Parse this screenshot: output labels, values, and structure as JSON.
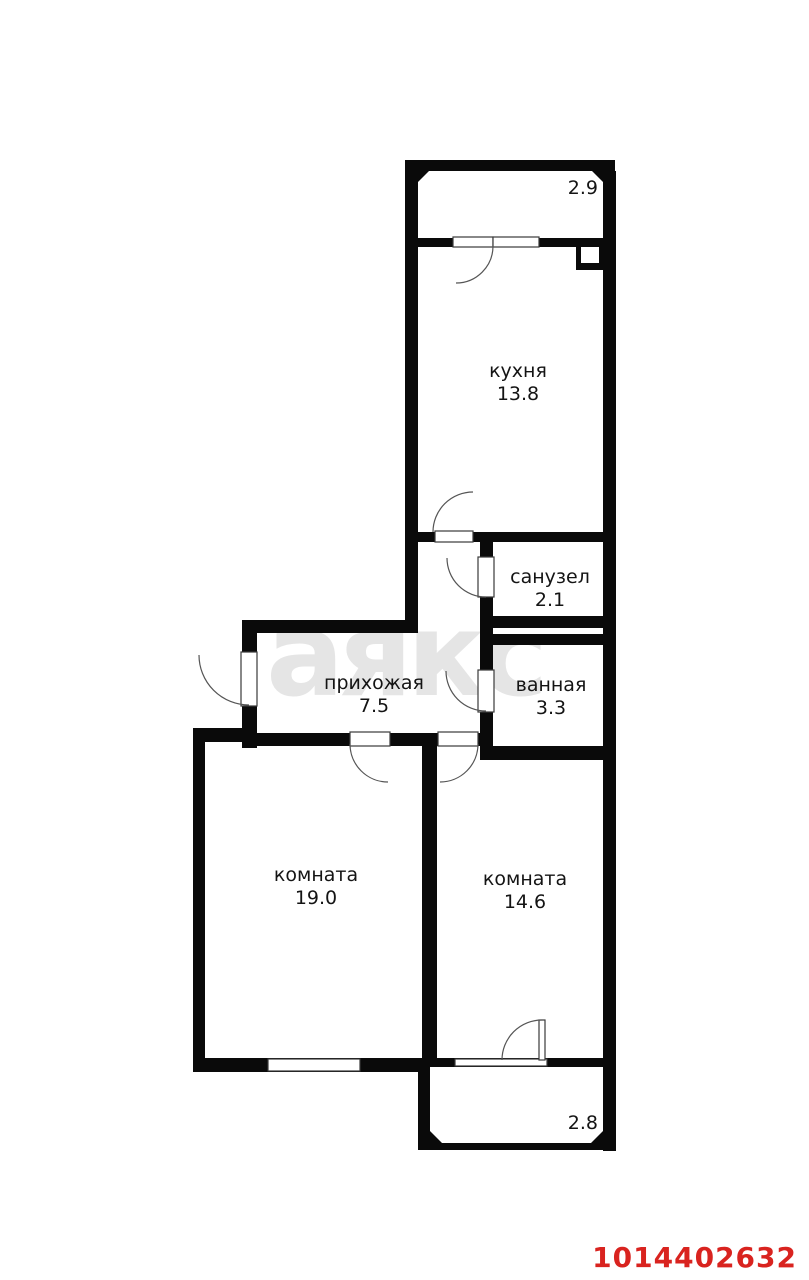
{
  "plan": {
    "watermark": "аякс",
    "listing_id": "1014402632",
    "rooms": [
      {
        "name": "кухня",
        "area": "13.8"
      },
      {
        "name": "санузел",
        "area": "2.1"
      },
      {
        "name": "ванная",
        "area": "3.3"
      },
      {
        "name": "прихожая",
        "area": "7.5"
      },
      {
        "name": "комната",
        "area": "19.0"
      },
      {
        "name": "комната",
        "area": "14.6"
      }
    ],
    "balconies": [
      {
        "area": "2.9"
      },
      {
        "area": "2.8"
      }
    ],
    "colors": {
      "wall": "#0a0a0a",
      "outline": "#3a3a3a",
      "arc": "#555555",
      "id_red": "#d9231f",
      "watermark_gray": "#e5e5e5"
    }
  }
}
